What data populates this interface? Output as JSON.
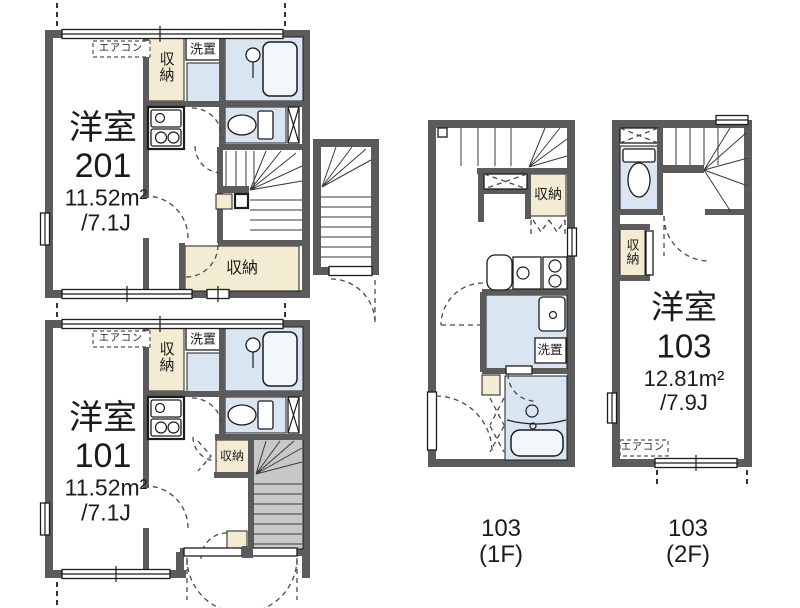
{
  "units": {
    "u201": {
      "room_type": "洋室",
      "number": "201",
      "area": "11.52m²",
      "tatami": "/7.1J",
      "aircon_label": "エアコン",
      "closet_label": "収納",
      "laundry_label": "洗置",
      "closet_bottom_label": "収納"
    },
    "u101": {
      "room_type": "洋室",
      "number": "101",
      "area": "11.52m²",
      "tatami": "/7.1J",
      "aircon_label": "エアコン",
      "closet_label": "収納",
      "laundry_label": "洗置",
      "closet_mid_label": "収納"
    },
    "u103_1f": {
      "closet_label": "収納",
      "laundry_label": "洗置",
      "caption": [
        "103",
        "(1F)"
      ]
    },
    "u103_2f": {
      "room_type": "洋室",
      "number": "103",
      "area": "12.81m²",
      "tatami": "/7.9J",
      "closet_label": "収納",
      "aircon_label": "エアコン",
      "caption": [
        "103",
        "(2F)"
      ]
    }
  },
  "colors": {
    "wall": "#5b5b5b",
    "wet_area": "#d9e6f2",
    "closet": "#f3ebd2",
    "stair_fill": "#c8c8c8",
    "outline": "#1c1c1c",
    "background": "#ffffff"
  }
}
